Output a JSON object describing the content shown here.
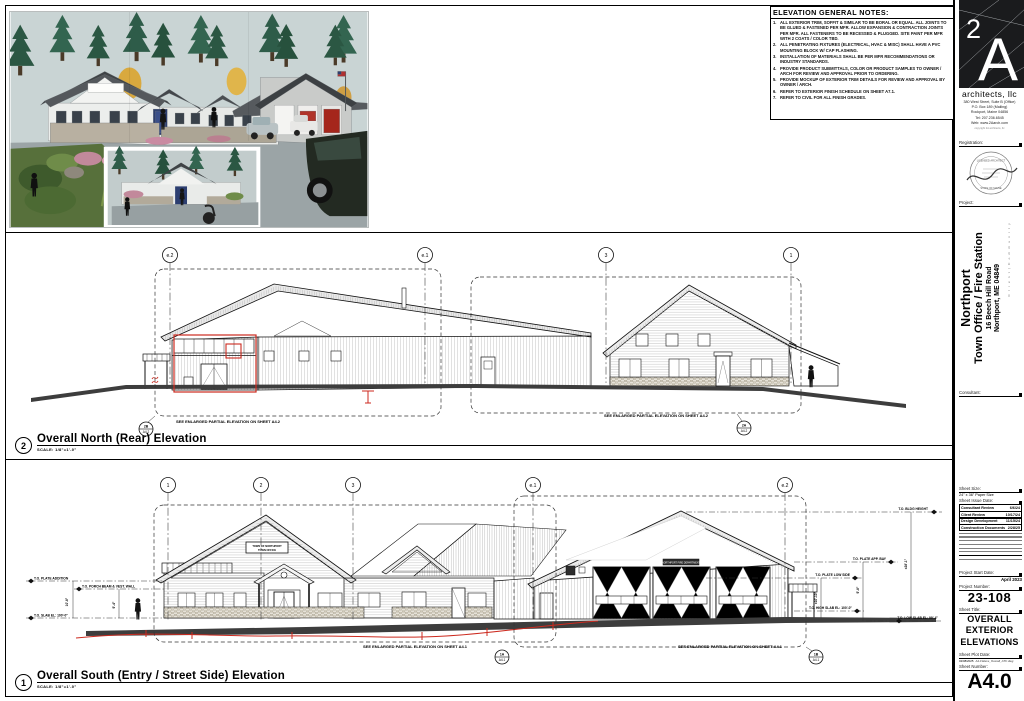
{
  "colors": {
    "annotation_red": "#cc2a1f",
    "line_black": "#000000",
    "ground_gray": "#3d3d3d",
    "sky": "#c9d4d4"
  },
  "sheet": {
    "notes": {
      "title": "ELEVATION GENERAL NOTES:",
      "items": [
        {
          "n": "1.",
          "t": "ALL EXTERIOR TRIM, SOFFIT & SIMILAR TO BE BORAL OR EQUAL. ALL JOINTS TO BE GLUED & FASTENED PER MFR. ALLOW EXPANSION & CONTRACTION JOINTS PER MFR. ALL FASTENERS TO BE RECESSED & PLUGGED. SITE PAINT PER MFR WITH 2 COATS / COLOR TBD."
        },
        {
          "n": "2.",
          "t": "ALL PENETRATING FIXTURES (ELECTRICAL, HVAC & MISC) SHALL HAVE A PVC MOUNTING BLOCK W/ CAP FLASHING."
        },
        {
          "n": "3.",
          "t": "INSTALLATION OF MATERIALS SHALL BE PER MFR RECOMMENDATIONS OR INDUSTRY STANDARDS."
        },
        {
          "n": "4.",
          "t": "PROVIDE PRODUCT SUBMITTALS, COLOR OR PRODUCT SAMPLES TO OWNER / ARCH FOR REVIEW AND APPROVAL PRIOR TO ORDERING."
        },
        {
          "n": "5.",
          "t": "PROVIDE MOCKUP OF EXTERIOR TRIM DETAILS FOR REVIEW AND APPROVAL BY OWNER / ARCH."
        },
        {
          "n": "6.",
          "t": "REFER TO EXTERIOR FINISH SCHEDULE ON SHEET A7.1."
        },
        {
          "n": "7.",
          "t": "REFER TO CIVIL FOR ALL FINISH GRADES."
        }
      ]
    },
    "views": {
      "north": {
        "bubble": "2",
        "title": "Overall North (Rear) Elevation",
        "scale": "SCALE:  1/8\"=1'-0\""
      },
      "south": {
        "bubble": "1",
        "title": "Overall South (Entry / Street Side) Elevation",
        "scale": "SCALE:  1/8\"=1'-0\""
      }
    },
    "north": {
      "grid": [
        "e.2",
        "e.1",
        "3",
        "1"
      ],
      "note_left": "SEE ENLARGED PARTIAL ELEVATION ON SHEET A4.2",
      "note_right": "SEE ENLARGED PARTIAL ELEVATION ON SHEET A4.2",
      "detail_left": {
        "id": "2B",
        "sheet": "A4.2"
      },
      "detail_right": {
        "id": "2A",
        "sheet": "A4.2"
      }
    },
    "south": {
      "grid": [
        "1",
        "2",
        "3",
        "e.1",
        "e.2"
      ],
      "note_left": "SEE ENLARGED PARTIAL ELEVATION ON SHEET A4.1",
      "note_right": "SEE ENLARGED PARTIAL ELEVATION ON SHEET A4.1",
      "detail_left": {
        "id": "1A",
        "sheet": "A4.1"
      },
      "detail_right": {
        "id": "1B",
        "sheet": "A4.1"
      },
      "callouts_left": [
        "T.O. PLATE ADDITION",
        "T.O. PORCH BEAM & VEST. WALL",
        "T.O. SLAB EL: 100'-0\""
      ],
      "callouts_right": [
        "T.O. BLDG HEIGHT",
        "T.O. PLATE APP. BAY",
        "T.O. PLATE LOW SIDE",
        "T.O. HIGH SLAB EL: 100'-0\"",
        "T.O. LOW SLAB EL: 99'-4\""
      ],
      "dims": {
        "overall": "±28'-1\"",
        "bay": "9'-8\"",
        "low": "±10'-10\"",
        "addition": "10'-8\"",
        "porch": "9'-4\""
      },
      "signs": {
        "entry_line1": "TOWN OF NORTHPORT",
        "entry_line2": "TOWN OFFICE",
        "fire": "NORTHPORT FIRE DEPARTMENT"
      }
    }
  },
  "titleblock": {
    "firm": {
      "logo_2": "2",
      "logo_A": "A",
      "name": "architects, llc",
      "address1": "380 West Street, Suite B (Office)",
      "address2": "P.O. Box 189 (Mailing)",
      "address3": "Rockport, Maine 04856",
      "tel": "Tel: 207.236.6545",
      "web": "Web: www.2Aarch.com",
      "copyright": "copyright 2A architects, llc"
    },
    "labels": {
      "registration": "Registration:",
      "project": "Project:",
      "consultant": "Consultant:",
      "sheet_size": "Sheet Size:",
      "sheet_issue_date": "Sheet Issue Date:",
      "project_start_date": "Project Start Date:",
      "project_number": "Project Number:",
      "sheet_title": "Sheet Title:",
      "sheet_plot_date": "Sheet Plot Date:",
      "sheet_number": "Sheet Number:"
    },
    "seal": {
      "arc_top": "LICENSED ARCHITECT",
      "arc_bottom": "STATE OF MAINE"
    },
    "project": {
      "name": "Northport",
      "subtitle": "Town Office / Fire Station",
      "address": "16 Beech Hill Road",
      "city": "Northport, ME 04849",
      "side_note": "C l i e n t   |   C o m m u n i t y"
    },
    "sheet_size_value": "24\" x 36\" Paper Size",
    "issue_dates": [
      {
        "label": "Consultant Review",
        "date": "6/6/24"
      },
      {
        "label": "Client Review",
        "date": "10/17/24"
      },
      {
        "label": "Design Development",
        "date": "11/15/24"
      },
      {
        "label": "Construction Documents",
        "date": "2/28/25"
      }
    ],
    "project_start_date": "April 2023",
    "project_number": "23-108",
    "sheet_title_l1": "OVERALL",
    "sheet_title_l2": "EXTERIOR",
    "sheet_title_l3": "ELEVATIONS",
    "plot_date": "02/08/2025",
    "plot_file": "A4.0 Elevs_Overall_ATC.dwg",
    "sheet_number": "A4.0"
  }
}
